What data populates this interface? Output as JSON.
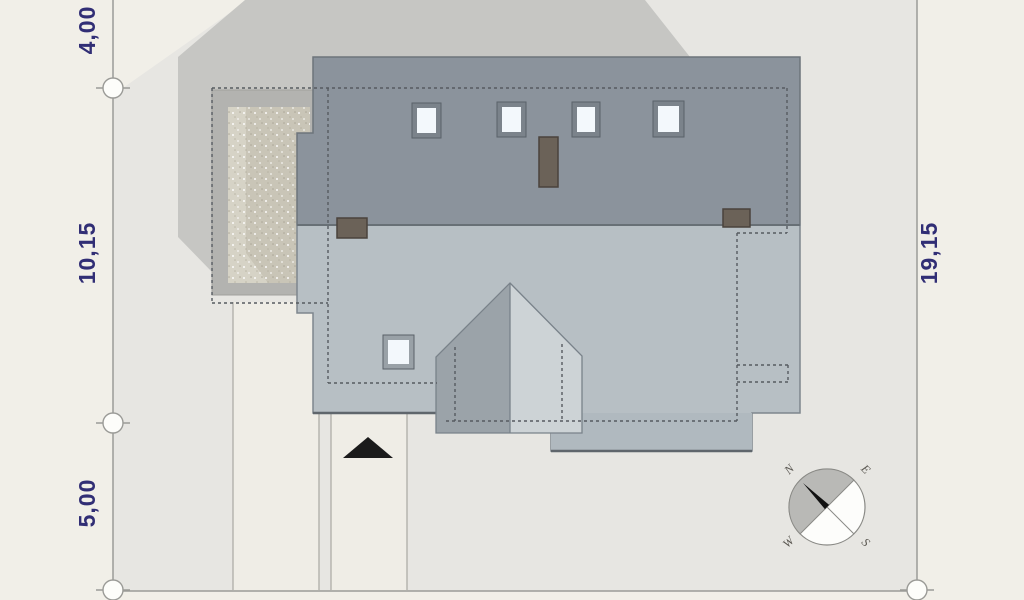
{
  "dimensions": {
    "left_top": "4,00",
    "left_middle": "10,15",
    "left_bottom": "5,00",
    "right_side": "19,15"
  },
  "compass": {
    "north": "N",
    "east": "E",
    "west": "W",
    "south": "S"
  },
  "colors": {
    "page_bg": "#f1efe8",
    "plot_bg": "#e7e6e2",
    "house_shadow": "#c6c6c3",
    "terrace_deck": "#b3b3b0",
    "terrace_paving_light": "#d6d3c6",
    "terrace_paving_dark": "#c9c5b7",
    "roof_upper": "#8b939c",
    "roof_lower": "#b7bfc4",
    "roof_extension": "#b0b9bf",
    "bay_roof_left": "#9ba3a9",
    "bay_roof_right": "#cdd3d6",
    "chimney": "#6b6258",
    "skylight_glass": "#f3f8fc",
    "skylight_frame_upper": "#7b838b",
    "skylight_frame_lower": "#99a1a7",
    "paving_strip": "#efede6",
    "dashed_outline": "#565b60",
    "boundary_line": "#9b9b97",
    "dimension_text": "#312e75",
    "entrance_arrow": "#1b1b1b",
    "compass_gray": "#b9b9b6",
    "compass_needle": "#111111",
    "compass_letter": "#5a5751"
  }
}
